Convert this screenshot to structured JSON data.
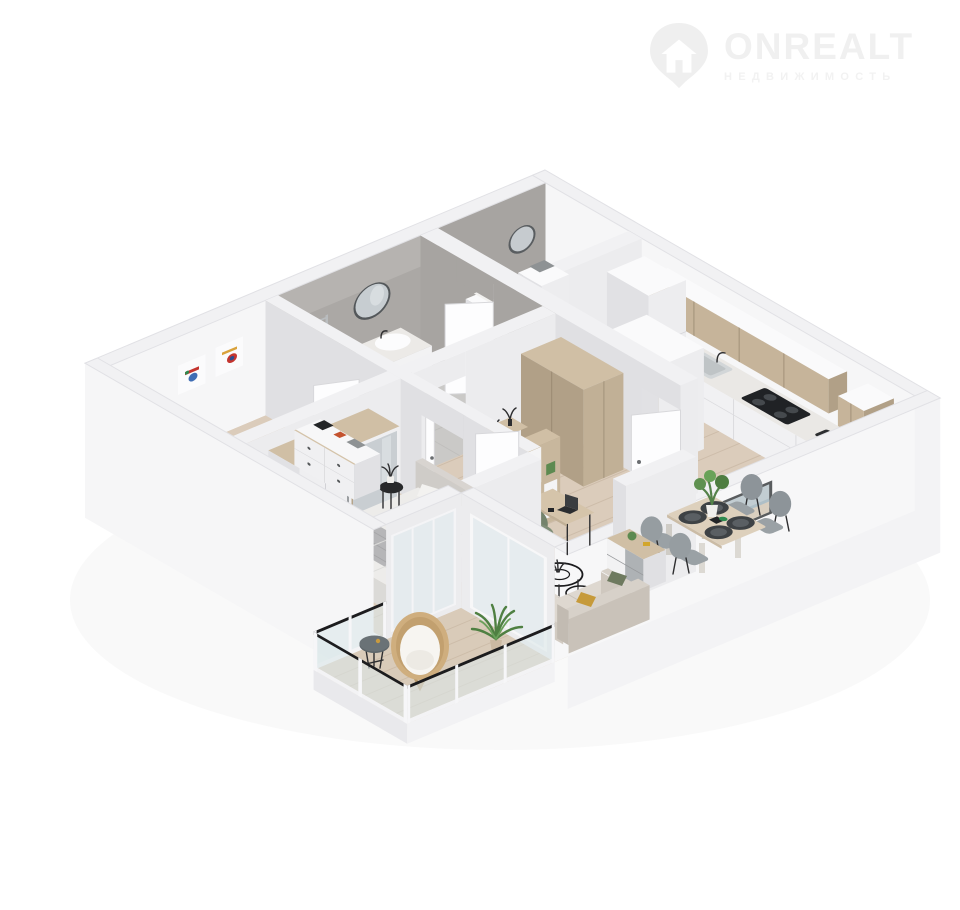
{
  "watermark": {
    "brand": "ONREALT",
    "subtitle": "НЕДВИЖИМОСТЬ",
    "icon": "location-pin-house-icon",
    "color": "#f0f0f0"
  },
  "scene": {
    "type": "isometric-3d-floor-plan-render",
    "background": "#ffffff",
    "rooms": [
      {
        "name": "kids-bedroom"
      },
      {
        "name": "bathroom"
      },
      {
        "name": "laundry-room"
      },
      {
        "name": "hallway"
      },
      {
        "name": "kitchen"
      },
      {
        "name": "dining-area"
      },
      {
        "name": "living-room"
      },
      {
        "name": "master-bedroom"
      },
      {
        "name": "balcony"
      }
    ]
  },
  "palette": {
    "wall_top": "#f1f1f3",
    "wall_light": "#f6f6f7",
    "concrete": "#a7a4a1",
    "wood_floor": "#dbccbb",
    "wood_furniture": "#d0bfa5",
    "balcony_floor": "#d9cbb9",
    "rug_living": "#b8bdb0",
    "rug_kids": "#d8d7d3",
    "sofa": "#ded8d0",
    "accent_green": "#6e7a5f",
    "accent_mustard": "#c69a3a",
    "pillow_blue": "#7fa0bd",
    "chair_green": "#7f8d77",
    "glass": "#dde7ea",
    "black": "#232527"
  }
}
